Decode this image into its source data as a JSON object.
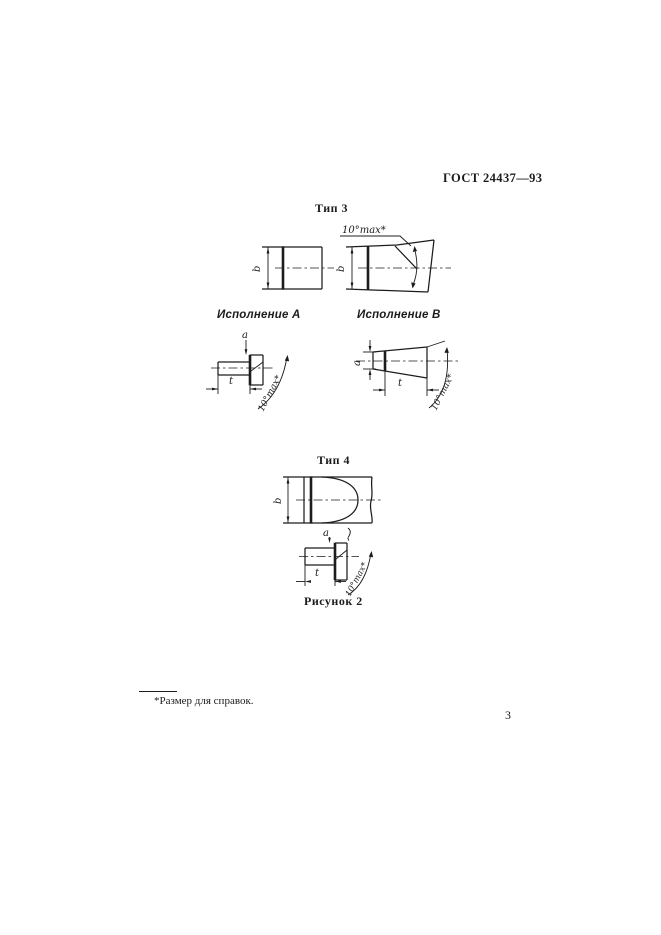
{
  "colors": {
    "ink": "#1c1c1c",
    "paper": "#ffffff"
  },
  "header": {
    "standard_ref": "ГОСТ 24437—93"
  },
  "type3": {
    "title": "Тип 3",
    "variant_a_label": "Исполнение А",
    "variant_b_label": "Исполнение В",
    "dims": {
      "b": "b",
      "a": "а",
      "t": "t",
      "angle_front": "10°max*",
      "angle_side_a": "10°max*",
      "angle_side_b": "10°max*"
    }
  },
  "type4": {
    "title": "Тип 4",
    "dims": {
      "b": "b",
      "a": "а",
      "t": "t",
      "angle_side": "10°max*"
    }
  },
  "caption": "Рисунок 2",
  "footnote": "*Размер для справок.",
  "page_number": "3"
}
